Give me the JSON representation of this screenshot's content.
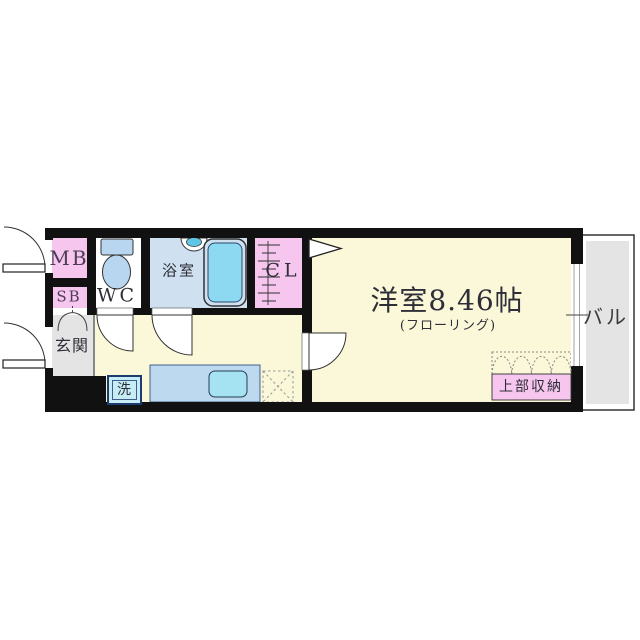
{
  "floorplan": {
    "labels": {
      "meter_box": "MB",
      "shaft_box": "SB",
      "toilet": "WC",
      "bathroom": "浴室",
      "closet": "CL",
      "entrance": "玄関",
      "washer": "洗",
      "main_room": "洋室8.46帖",
      "main_room_floor": "(フローリング)",
      "upper_storage": "上部収納",
      "balcony": "バル"
    },
    "colors": {
      "wall": "#111111",
      "pink": "#f6c6ee",
      "room_yellow": "#fbf8da",
      "bath_blue": "#cfe1f0",
      "fixture_blue": "#b9d6f0",
      "tub_cyan": "#8ed9f2",
      "basin_cyan": "#5fc6e8",
      "counter_blue": "#bcd9ef",
      "sink_cyan": "#a5e3f3",
      "washer_cyan": "#c6ecf6",
      "gray": "#e4e4e4",
      "white": "#ffffff"
    }
  }
}
